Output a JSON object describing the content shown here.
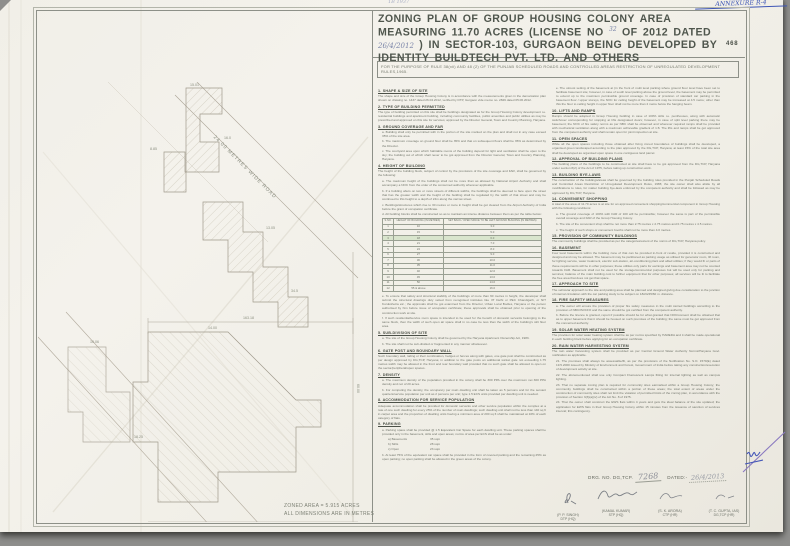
{
  "annotations": {
    "annexure": "ANNEXURE R-4",
    "top_mark": "1B 1937",
    "page_number": "468"
  },
  "title": {
    "t1": "ZONING PLAN OF GROUP HOUSING COLONY AREA MEASURING 11.70 ACRES (LICENSE NO",
    "license_no": "32",
    "t2": "OF 2012 DATED",
    "license_date": "26/4/2012",
    "t3": ") IN SECTOR-103, GURGAON BEING DEVELOPED BY IDENTITY BUILDTECH PVT. LTD. AND OTHERS"
  },
  "purpose_note": "FOR THE PURPOSE OF RULE 38(xii) AND 48 (2) OF THE PUNJAB SCHEDULED ROADS AND CONTROLLED AREAS RESTRICTION OF UNREGULATED DEVELOPMENT RULES,1965.",
  "drawing": {
    "road_label": "24.00 METRES WIDE ROAD",
    "dims": [
      "15.01",
      "8.85",
      "16.0",
      "13.05",
      "34.5",
      "14.00",
      "163.18",
      "60.00",
      "18.25",
      "10.06"
    ],
    "zoned_area": "ZONED AREA = 5.915 ACRES",
    "units_note": "ALL DIMENSIONS ARE IN METRES"
  },
  "setback_table": {
    "headers": [
      "S.NO.",
      "HEIGHT OF BUILDING (IN METRES)",
      "SET BACK / OPEN SPACE TO BE LEFT AROUND BUILDING (IN METRES)"
    ],
    "rows": [
      [
        "1",
        "10",
        "3.0"
      ],
      [
        "2",
        "15",
        "5.0"
      ],
      [
        "3",
        "18",
        "6.0"
      ],
      [
        "4",
        "21",
        "7.0"
      ],
      [
        "5",
        "24",
        "8.0"
      ],
      [
        "6",
        "27",
        "9.0"
      ],
      [
        "7",
        "30",
        "10.0"
      ],
      [
        "8",
        "35",
        "11.0"
      ],
      [
        "9",
        "40",
        "12.0"
      ],
      [
        "10",
        "45",
        "13.0"
      ],
      [
        "11",
        "50",
        "14.0"
      ],
      [
        "12",
        "55 & above",
        "16.0"
      ]
    ],
    "highlight_row": 2
  },
  "left_column": {
    "sections": [
      {
        "heading": "1. SHAPE & SIZE OF SITE",
        "paras": [
          "The shape and size of the Group Housing Colony is in accordance with the measurements given in the demarcation plan shown on drawing no. 1437 dated 26.04.2012, verified by DTP, Gurgaon vide memo no. 2829 dated 05.06.2012."
        ]
      },
      {
        "heading": "2. TYPE OF BUILDING PERMITTED",
        "paras": [
          "The type of building permitted on this site shall be buildings designated as for the Group Housing Colony development i.e. residential buildings and apartment building, including community facilities, public amenities and public utilities as may be prescribed and approved on this site for services; approved by the Director General, Town and Country Planning, Haryana."
        ]
      },
      {
        "heading": "3. GROUND COVERAGE AND FAR",
        "paras": [
          "a. Building shall only be permitted with in the portion of the site marked on the plan and shall not in any case exceed 35% of the site area.",
          "b. The maximum coverage on ground floor shall be 35% and that on subsequent floors shall be 35% as determined by the Director.",
          "c. The courtyard area upon which habitable rooms of the building depend for light and ventilation shall be open to the sky; the building out of which shall never to be got approved from the Director General, Town and Country Planning, Haryana."
        ]
      },
      {
        "heading": "4. HEIGHT OF BUILDING",
        "paras": [
          "The height of the building block, subject of control by the provisions of the site coverage and FAR, shall be governed by the following:",
          "a. The maximum height of the buildings shall not be more than as allowed by National Airport Authority and shall accompany a NOC from the order of the concerned authority wherever applicable.",
          "b. If a building abuts on two or more streets of different widths, the buildings shall be deemed to face upon the street that has the greater width and the height of the building shall be regulated by the width of that street and may be continued to this height to a depth of 24m along the narrow street.",
          "c. Buildings/structures which rise to 30 metres or more in height shall be got cleared from the Airport Authority of India before the grant of occupation certificate.",
          "d. All building blocks shall be constructed so as to maintain an interse distance between them as per the table below:",
          "e. To ensure that safety and structural stability of the buildings of more than 60 metres in height, the developer shall submit the structural drawings duly vetted from recognised institutes like IIT Delhi or PEC Chandigarh, or NIT Kurukshetra etc.; the approvals shall be got examined from the Director, Urban Local Bodies, Haryana or the person authorised by him before issue of occupation certificate; these approvals shall be obtained prior to opening of the construction work at site.",
          "f. If such residential/service room space is intended to be used for the benefit of domestic servants belonging to the same block, then the width of such open air space shall in no case be less than the width of the building's stilt floor area."
        ],
        "table_after": 4
      },
      {
        "heading": "5. SUB-DIVISION OF SITE",
        "paras": [
          "a. The site of the Group Housing Colony shall be governed by the Haryana Apartment Ownership Act, 1983.",
          "b. The site shall not be sub-divided or fragmented in any manner whatsoever."
        ]
      },
      {
        "heading": "6. GATE POST AND BOUNDARY WALL",
        "paras": [
          "Such boundary wall, railing or their combination, hedges or fences along with gates, one gate post shall be constructed as per design approved by DG,TCP, Haryana; in addition to the gate posts an additional wicket gate not exceeding 1.75 metres width may be allowed in the front and rear boundary wall provided that no such gate shall be allowed to open on the sector/peripheral/open spaces."
        ]
      },
      {
        "heading": "7. DENSITY",
        "paras": [
          "a. The maximum density of the population provided in the colony shall be 300 PPA over the maximum net 300 PPA density and not of 20 acres.",
          "b. For computing the density, the occupancy per main dwelling unit shall be taken as 5 persons and for the servant quarters/service population per unit as 2 persons per unit; type 1.5 ECS units provided per dwelling unit is needed."
        ]
      },
      {
        "heading": "8. ACCOMMODATION FOR SERVICE POPULATION",
        "paras": [
          "Adequate accommodation shall be provided for domestic servants and other service population within the complex at a rate of one such dwelling for every 25% of the number of main dwellings; such dwelling unit shall not be less than 140 sq ft in carpet area and the proportion of dwelling units having a minimum area of 200 sq ft shall be maintained at 10% of each category of flats."
        ]
      },
      {
        "heading": "9. PARKING",
        "paras": [
          "a. Parking space shall be provided @ 1.5 Equivalent Car Space for each dwelling unit. These parking spaces shall be provided only in the basement, stilts and open areas; norms of area per ECS shall be as under:",
          "b. At least 75% of the equivalent car space shall be provided in the form of covered parking and the remaining 25% as open parking; no open parking shall be allowed in the green areas of the colony."
        ],
        "sublist_after": 0,
        "sublist": [
          [
            "a) Basements",
            "35 sqm"
          ],
          [
            "b) Stilts",
            "28 sqm"
          ],
          [
            "c) Open",
            "23 sqm"
          ]
        ]
      }
    ]
  },
  "right_column": {
    "sections": [
      {
        "paras": [
          "e. The utmost setting of the basement at (in the front of multi level parking where ground floor level have been set to facilitate basement site; however, in case of south level parking above the ground level, the basement may be permitted to extend up to the maximum permissible ground coverage. In case of provision of standard car parking in the basement floor / upper storeys, the NOC for ceiling height of the basement may be increased at 4.5 metre; other than this the floor to ceiling height in upper floor shall not be more than 2 metre below the hanging beam."
        ]
      },
      {
        "heading": "10. LIFTS AND RAMPS",
        "paras": [
          "Ramps should be adopted in Group Housing building in case of 100% stilts i.e. penthouses, along with automatic switchover corresponding for stopping at lifts designated doors; however, in case of split level parking there may be basement; the NOC of fire safety norms as per NBC shall be observed and wherever required ramps shall be provided with mechanical ventilation along with a maximum achievable gradient of 1:8. The lifts and ramps shall be got approved from the competent authority and shall remain open for joint inspection at site."
        ]
      },
      {
        "heading": "11. OPEN SPACES",
        "paras": [
          "While all the open spaces including those obtained after fixing zoned boundaries of buildings shall be developed, a organised green landscaped according to the plan approved by the DG,TCP, Haryana; at least 15% of the total site area shall be developed as organised open space in one contiguous land parcel."
        ]
      },
      {
        "heading": "12. APPROVAL OF BUILDING PLANS",
        "paras": [
          "The building plans of the buildings to be constructed at site shall have to be got approved from the DG,TCP, Haryana under section 8(2) of the Act of 1975, before taking up construction work."
        ]
      },
      {
        "heading": "13. BUILDING BYE-LAWS",
        "paras": [
          "The construction of the buildings/areas shall be governed by the building rules provided in the Punjab Scheduled Roads and Controlled Areas Restriction of Unregulated Development Rules, 1965; the site owner shall also abide by all modifications to rules, for matter building bye-laws enforced by the competent authority and shall be followed as may be approved by DG,TCP, Haryana."
        ]
      },
      {
        "heading": "14. CONVENIENT SHOPPING",
        "paras": [
          "A total of the area of 11.70 acres is at site for an approved convenient shopping/commercial component in Group Housing with the following conditions:",
          "a. The ground coverage of 100% with FAR of 100 will be permissible; however the same is part of the permissible overall coverage and FAR of the Group Housing Colony.",
          "b. The site of the convenient shop shall be not more than 2.75 metres x 2.75 metres and 0.75 metres x 4.5 metres.",
          "c. The height of such shops or convenient booths shall not be more than 4.0 metres."
        ]
      },
      {
        "heading": "15. PROVISION OF COMMUNITY BUILDINGS",
        "paras": [
          "The community buildings shall be provided as per the categories/extent of the norms of DG,TCP, Haryana policy."
        ]
      },
      {
        "heading": "16. BASEMENT",
        "paras": [
          "Four level basements within the building zone of that can be provided in-front of reside, provided it is constructed and designed and may be allowed. The basement may be partitioned as parking usage as utilised for generator room, lift room, for lighting service, water treatment, electric sub-station, air-conditioning plant and allied utilities; if they would fit or parts of these requirements will be in other purposes; these utilities only parts for earnings and basement area may not be counted towards FAR. Basement shall not be used for the storage/commercial purposes but will be used only for parking and services; balance of the main building cost to further equipment that for other purposes; all services will be lit to facilitate the free area that does not get that space."
        ]
      },
      {
        "heading": "17. APPROACH TO SITE",
        "paras": [
          "The vehicular approach to the site and parking area shall be planned and designed giving due consideration to the junction of internal circulation with the car parking study to be subject on 18/24/45/60 m. distance."
        ]
      },
      {
        "heading": "18. FIRE SAFETY MEASURES",
        "paras": [
          "a. The owner will ensure the provision of proper fire safety measures in the multi storied buildings according to the provision of NBC/ISI/CFO and the same should be got certified from the competent authority.",
          "b. Before the licence is granted, report if possible should be for what granted that NOC/consent shall be obtained that as to upper basement that it should be housed on such premises of the building; the same must be got approved from the concerned authority."
        ]
      },
      {
        "heading": "19. SOLAR WATER HEATING SYSTEM",
        "paras": [
          "The provision for solar water heating system shall be as per norms specified by HAREDA and it shall be made operational in each building block before applying for an occupation certificate."
        ]
      },
      {
        "heading": "20. RAIN WATER HARVESTING SYSTEM",
        "paras": [
          "The rain water harvesting system shall be provided as per Central Ground Water Authority Norms/Haryana Govt. notification as applicable.",
          "21. The premises shall always be assessable/fit, as per the provisions of the Notification No. S.O. 1570(E) dated 19.5.2000 issued by Ministry of Environment and Forest, Government of India before taking any construction/execution of development activity at site.",
          "22. The aforementioned shall use only Compact Fluorescent Lamps fitting for internal lighting as well as campus lighting.",
          "23. That no separate zoning plan is required for community sites earmarked within a Group Housing Colony; the community buildings shall be constructed within a portion of these areas; the total extent of areas under the construction of community sites shall not limit the violation of permitted limits of the zoning plan, in accordance with the provision of Section 3(3)(a)(iv) of the Act No. 8 of 1975.",
          "24. That the owner shall construct the EWS flats within 4 years and gets the ideal balance of the site updated; the application for EWS flats in their Group Housing Colony within 15 minutes from the issuance of sanction of services interval; this contingency."
        ]
      }
    ]
  },
  "drg": {
    "label": "DRG. NO. DG,TCP.",
    "no": "7268",
    "dated_label": "DATED:-",
    "date": "26/4/2013"
  },
  "signatures": [
    {
      "name": "(P. P. SINGH)",
      "title": "DTP (HQ)"
    },
    {
      "name": "(KAMAL KUMAR)",
      "title": "STP (HQ)"
    },
    {
      "name": "(S. K. ARORA)",
      "title": "CTP (HR)"
    },
    {
      "name": "(T. C. GUPTA, IAS)",
      "title": "DG,TCP (HR)"
    }
  ],
  "colors": {
    "ink_blue": "#3d55b5",
    "print_gray": "#70746a",
    "highlight_green": "#d9e5cd",
    "paper": "#f2f0e9"
  }
}
